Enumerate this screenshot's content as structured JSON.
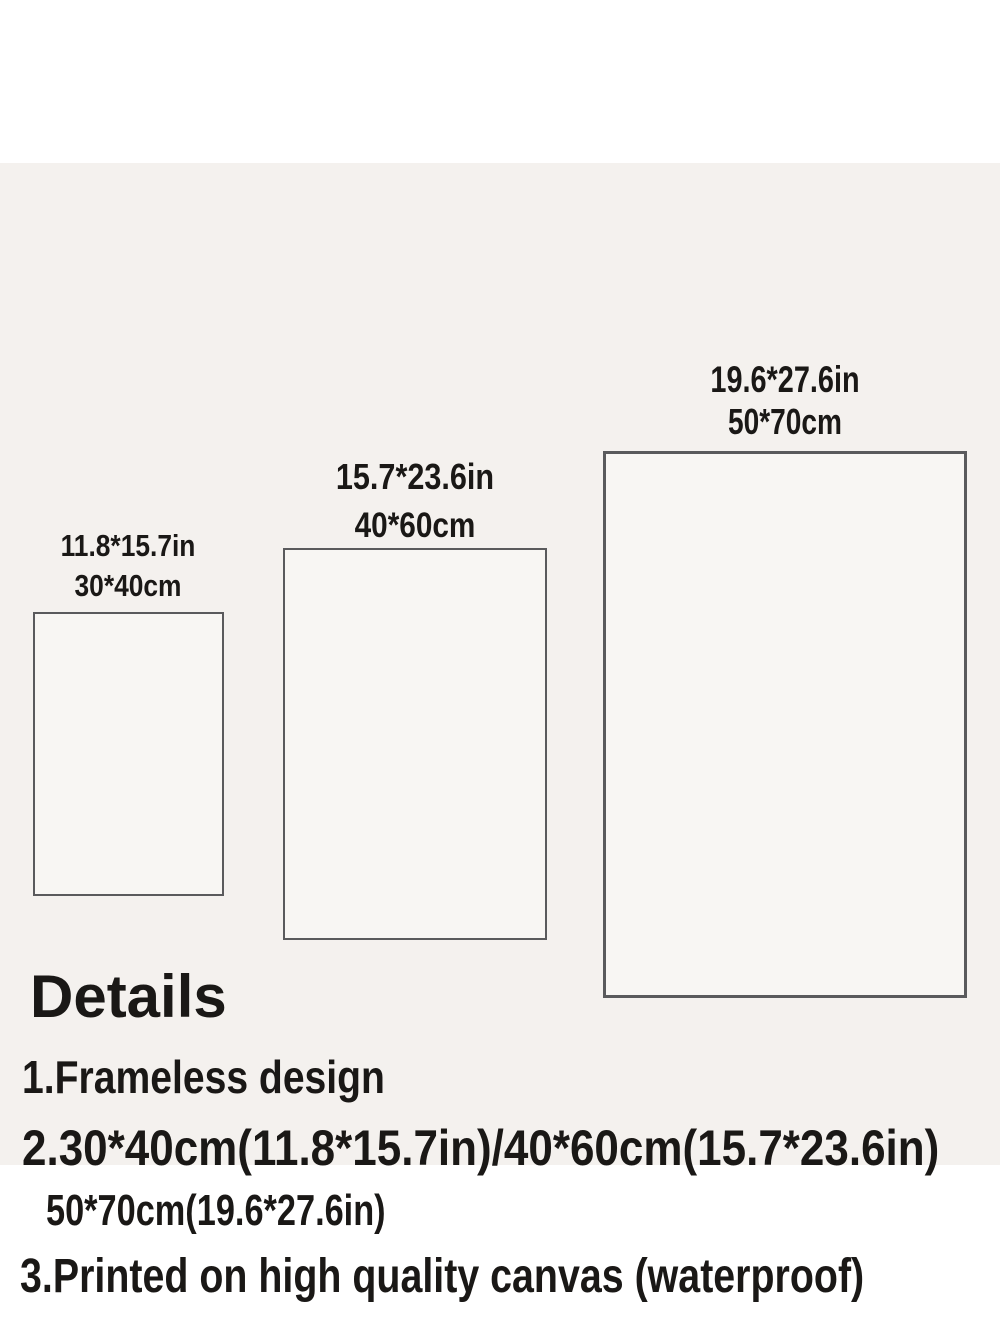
{
  "page": {
    "description": "Product size chart image for frameless canvas prints",
    "colors": {
      "page_bg": "#ffffff",
      "panel_bg": "#f4f1ee",
      "rect_fill": "#f8f6f3",
      "rect_border": "#5a5a5c",
      "text_color": "#1a1816"
    }
  },
  "size_chart": {
    "sizes": [
      {
        "inches": "11.8*15.7in",
        "cm": "30*40cm"
      },
      {
        "inches": "15.7*23.6in",
        "cm": "40*60cm"
      },
      {
        "inches": "19.6*27.6in",
        "cm": "50*70cm"
      }
    ]
  },
  "details": {
    "heading": "Details",
    "lines": [
      "1.Frameless design",
      "2.30*40cm(11.8*15.7in)/40*60cm(15.7*23.6in)",
      "50*70cm(19.6*27.6in)",
      "3.Printed on high quality canvas (waterproof)"
    ]
  }
}
